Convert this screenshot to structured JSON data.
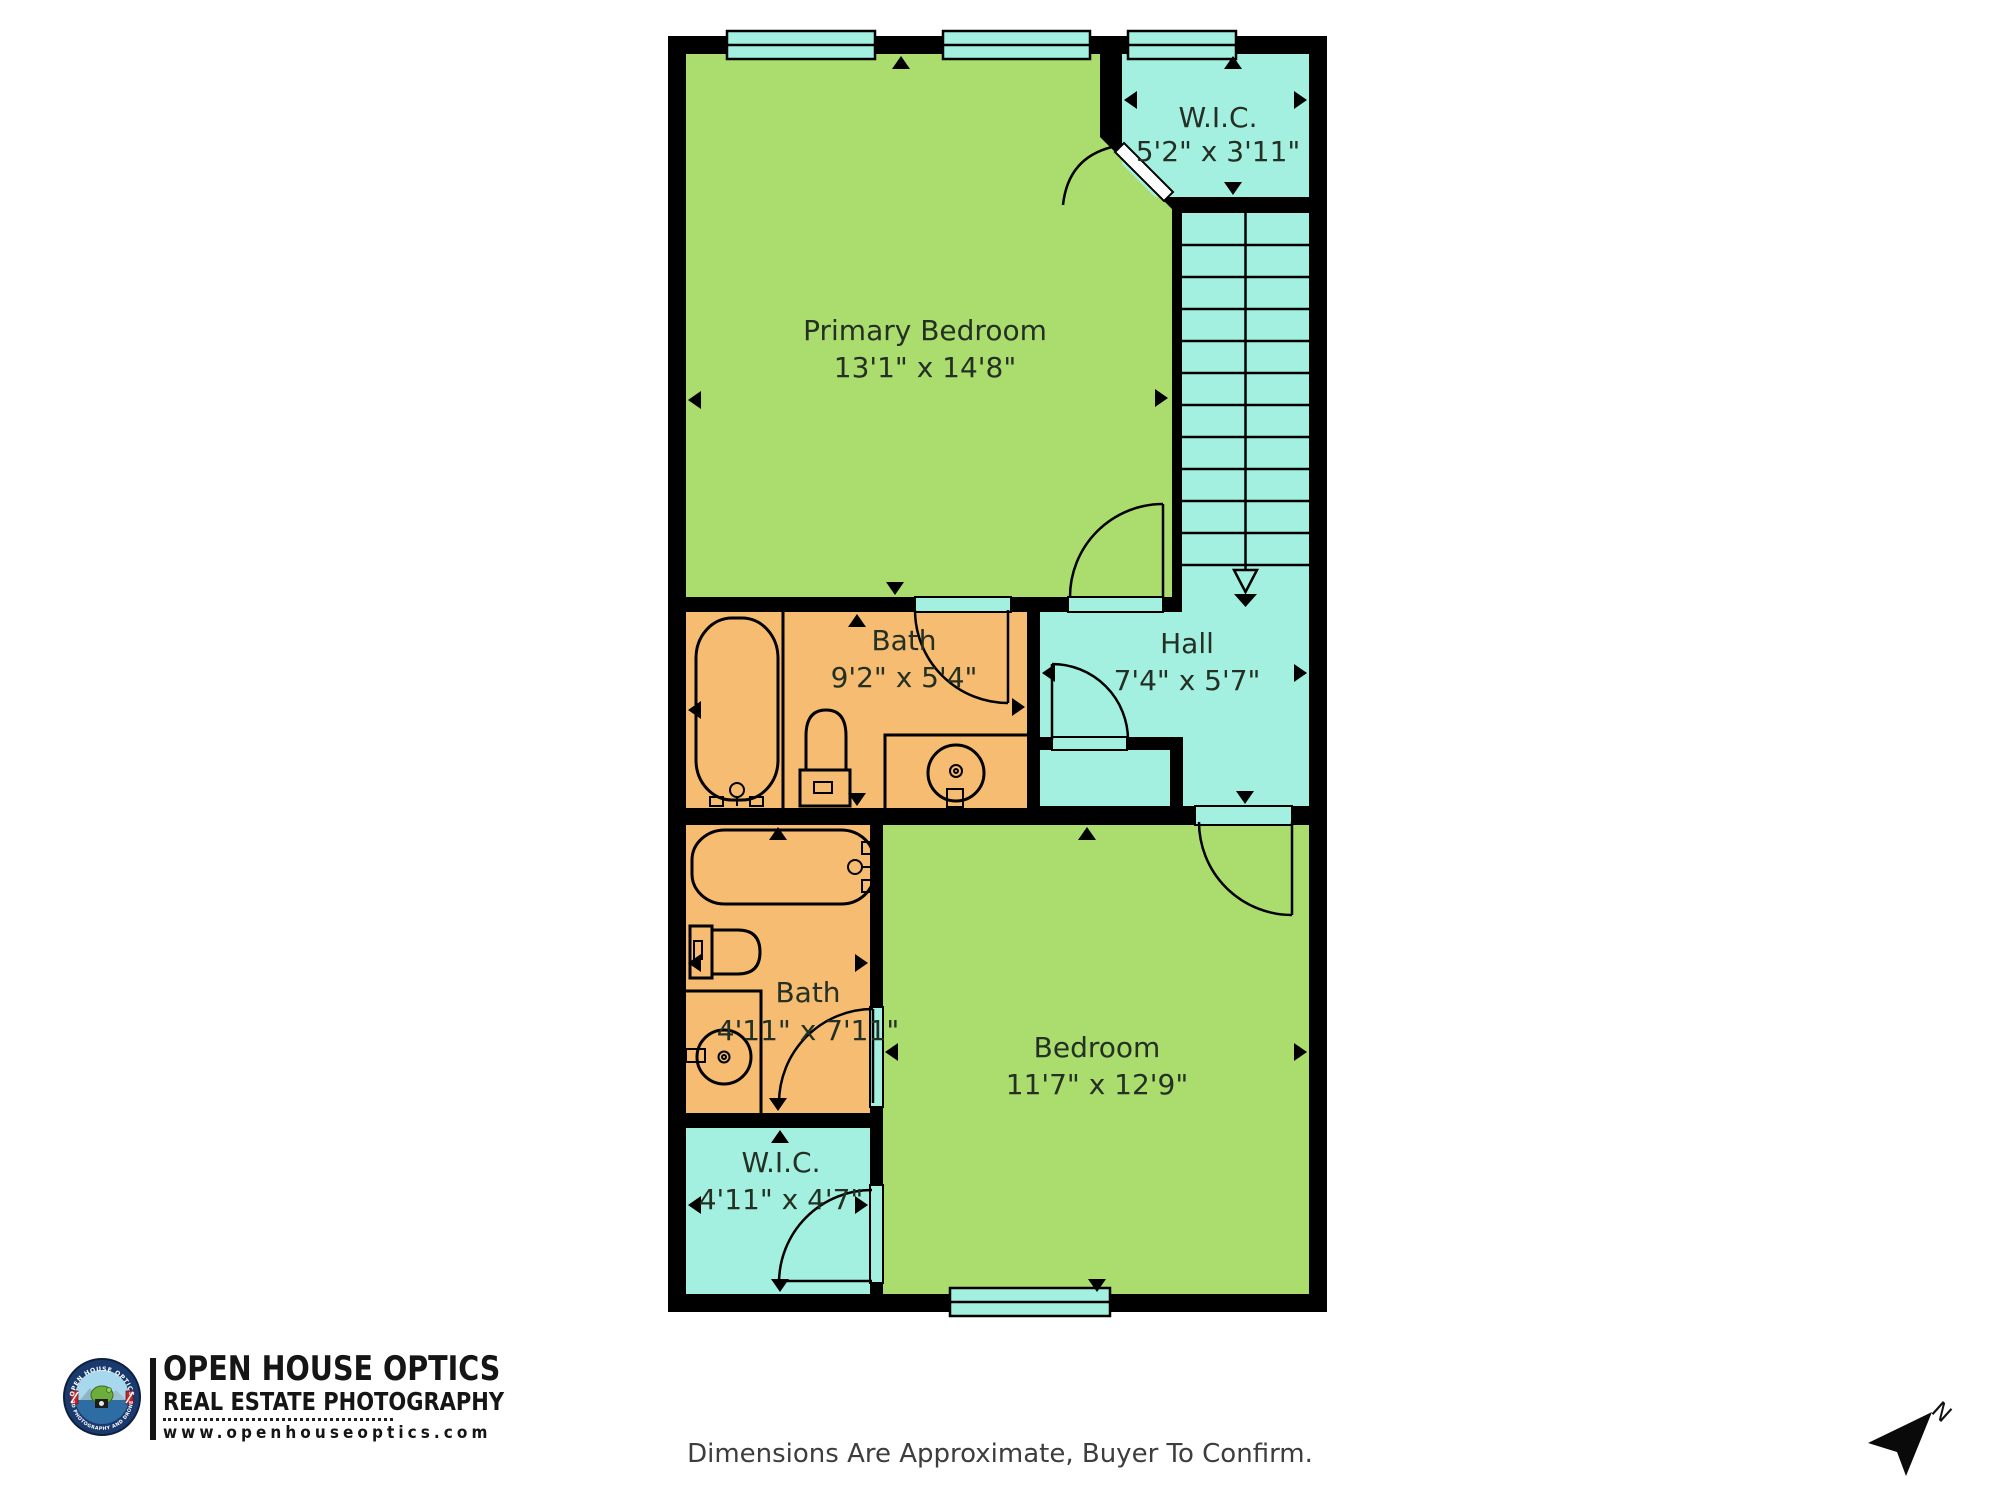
{
  "colors": {
    "room_green": "#abdc6e",
    "room_cyan": "#a4f0e0",
    "room_orange": "#f6bc72",
    "wall_black": "#000000",
    "label_text": "#233023"
  },
  "rooms": {
    "primary_bedroom": {
      "name": "Primary Bedroom",
      "dims": "13'1\" x 14'8\""
    },
    "wic_upper": {
      "name": "W.I.C.",
      "dims": "5'2\" x 3'11\""
    },
    "hall": {
      "name": "Hall",
      "dims": "7'4\" x 5'7\""
    },
    "bath_upper": {
      "name": "Bath",
      "dims": "9'2\" x 5'4\""
    },
    "bath_lower": {
      "name": "Bath",
      "dims": "4'11\" x 7'11\""
    },
    "wic_lower": {
      "name": "W.I.C.",
      "dims": "4'11\" x 4'7\""
    },
    "bedroom": {
      "name": "Bedroom",
      "dims": "11'7\" x 12'9\""
    }
  },
  "branding": {
    "company": "OPEN HOUSE OPTICS",
    "tagline": "REAL ESTATE PHOTOGRAPHY",
    "website": "www.openhouseoptics.com",
    "badge_arc_top": "OPEN HOUSE OPTICS",
    "badge_arc_bottom": "3D PHOTOGRAPHY AND DRONE"
  },
  "footer": {
    "disclaimer": "Dimensions Are Approximate, Buyer To Confirm."
  },
  "compass": {
    "north_label": "N"
  }
}
